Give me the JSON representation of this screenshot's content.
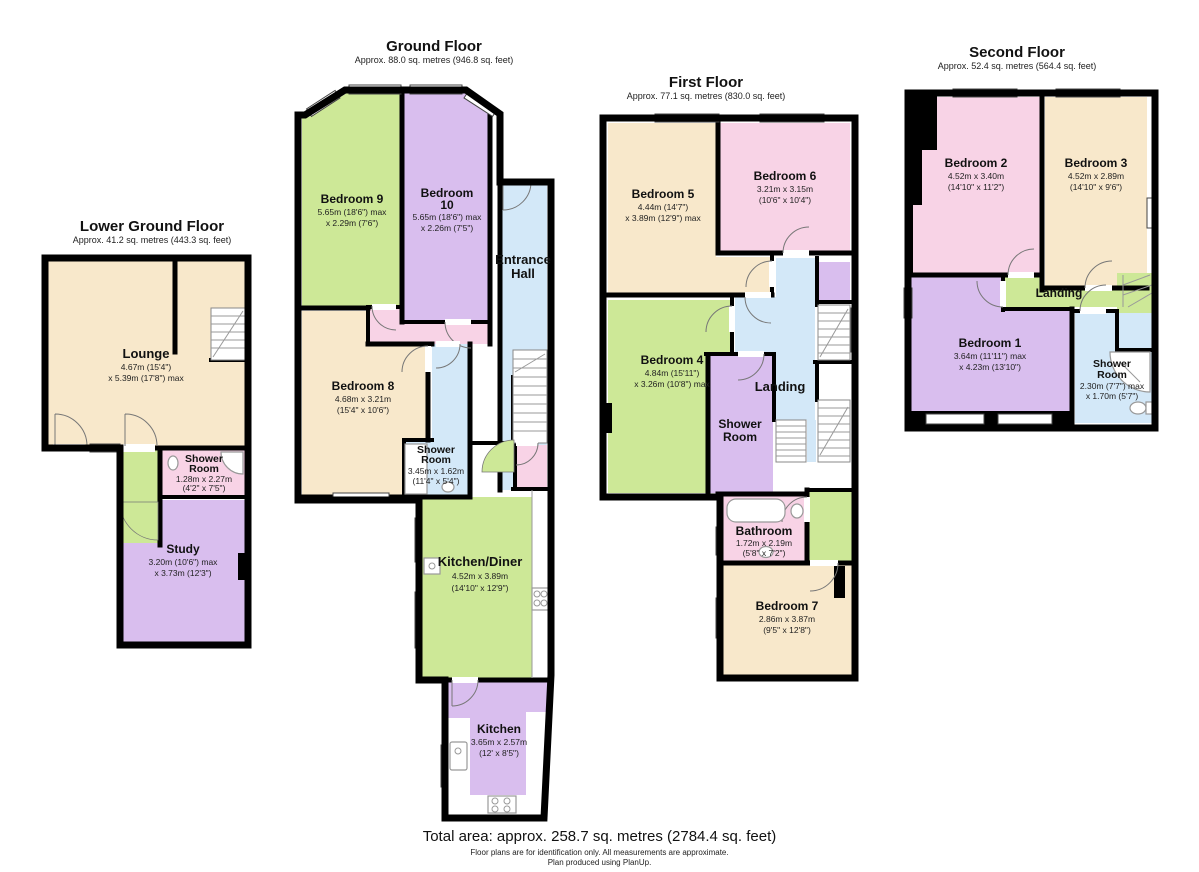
{
  "palette": {
    "room_cream": "#F8E8CB",
    "room_green": "#CDE897",
    "room_purple": "#D9BEEE",
    "room_pink": "#F8D3E6",
    "room_blue": "#D3E8F8",
    "wall": "#000000"
  },
  "floors": {
    "lower_ground": {
      "title": "Lower Ground Floor",
      "subtitle": "Approx. 41.2 sq. metres (443.3 sq. feet)",
      "rooms": {
        "lounge": {
          "name": "Lounge",
          "dim1": "4.67m (15'4\")",
          "dim2": "x 5.39m (17'8\") max"
        },
        "shower_room": {
          "name1": "Shower",
          "name2": "Room",
          "dim1": "1.28m x 2.27m",
          "dim2": "(4'2\" x 7'5\")"
        },
        "study": {
          "name": "Study",
          "dim1": "3.20m (10'6\") max",
          "dim2": "x 3.73m (12'3\")"
        }
      }
    },
    "ground": {
      "title": "Ground Floor",
      "subtitle": "Approx. 88.0 sq. metres (946.8 sq. feet)",
      "rooms": {
        "bedroom9": {
          "name": "Bedroom 9",
          "dim1": "5.65m (18'6\") max",
          "dim2": "x 2.29m (7'6\")"
        },
        "bedroom10": {
          "name1": "Bedroom",
          "name2": "10",
          "dim1": "5.65m (18'6\") max",
          "dim2": "x 2.26m (7'5\")"
        },
        "entrance_hall": {
          "name1": "Entrance",
          "name2": "Hall"
        },
        "bedroom8": {
          "name": "Bedroom 8",
          "dim1": "4.68m x 3.21m",
          "dim2": "(15'4\" x 10'6\")"
        },
        "shower_room": {
          "name1": "Shower",
          "name2": "Room",
          "dim1": "3.45m x 1.62m",
          "dim2": "(11'4\" x 5'4\")"
        },
        "kitchen_diner": {
          "name": "Kitchen/Diner",
          "dim1": "4.52m x 3.89m",
          "dim2": "(14'10\" x 12'9\")"
        },
        "kitchen": {
          "name": "Kitchen",
          "dim1": "3.65m x 2.57m",
          "dim2": "(12' x 8'5\")"
        }
      }
    },
    "first": {
      "title": "First Floor",
      "subtitle": "Approx. 77.1 sq. metres (830.0 sq. feet)",
      "rooms": {
        "bedroom5": {
          "name": "Bedroom 5",
          "dim1": "4.44m (14'7\")",
          "dim2": "x 3.89m (12'9\") max"
        },
        "bedroom6": {
          "name": "Bedroom 6",
          "dim1": "3.21m x 3.15m",
          "dim2": "(10'6\" x 10'4\")"
        },
        "bedroom4": {
          "name": "Bedroom 4",
          "dim1": "4.84m (15'11\")",
          "dim2": "x 3.26m (10'8\") max"
        },
        "landing": {
          "name": "Landing"
        },
        "shower_room": {
          "name1": "Shower",
          "name2": "Room"
        },
        "bathroom": {
          "name": "Bathroom",
          "dim1": "1.72m x 2.19m",
          "dim2": "(5'8\" x 7'2\")"
        },
        "bedroom7": {
          "name": "Bedroom 7",
          "dim1": "2.86m x 3.87m",
          "dim2": "(9'5\" x 12'8\")"
        }
      }
    },
    "second": {
      "title": "Second Floor",
      "subtitle": "Approx. 52.4 sq. metres (564.4 sq. feet)",
      "rooms": {
        "bedroom2": {
          "name": "Bedroom 2",
          "dim1": "4.52m x 3.40m",
          "dim2": "(14'10\" x 11'2\")"
        },
        "bedroom3": {
          "name": "Bedroom 3",
          "dim1": "4.52m x 2.89m",
          "dim2": "(14'10\" x 9'6\")"
        },
        "landing": {
          "name": "Landing"
        },
        "bedroom1": {
          "name": "Bedroom 1",
          "dim1": "3.64m (11'11\") max",
          "dim2": "x 4.23m (13'10\")"
        },
        "shower_room": {
          "name1": "Shower",
          "name2": "Room",
          "dim1": "2.30m (7'7\") max",
          "dim2": "x 1.70m (5'7\")"
        }
      }
    }
  },
  "footer": {
    "total_area": "Total area: approx. 258.7 sq. metres (2784.4 sq. feet)",
    "disclaimer_line1": "Floor plans are for identification only. All measurements are approximate.",
    "disclaimer_line2": "Plan produced using PlanUp."
  }
}
